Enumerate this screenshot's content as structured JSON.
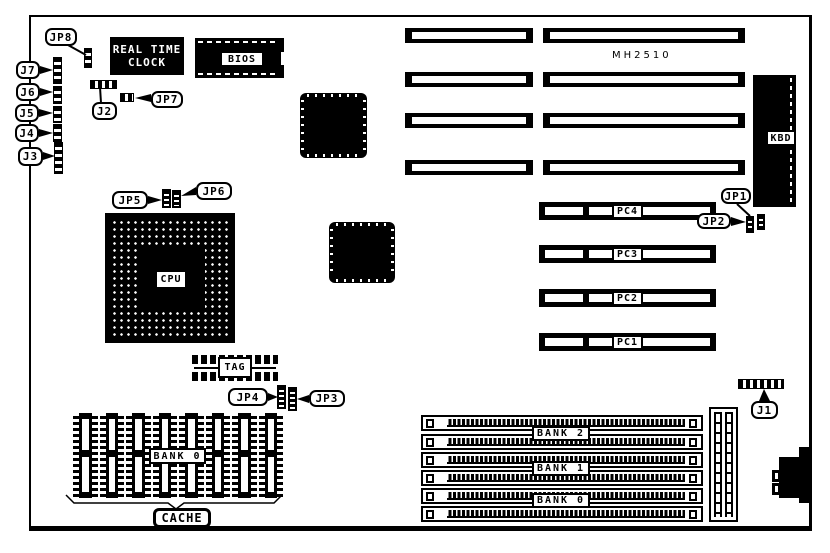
{
  "diagram": {
    "model_text": "MH2510",
    "colors": {
      "ink": "#000000",
      "paper": "#ffffff"
    }
  },
  "components": {
    "rtc_line1": "REAL TIME",
    "rtc_line2": "CLOCK",
    "bios_label": "BIOS",
    "cpu_label": "CPU",
    "tag_label": "TAG",
    "kbd_label": "KBD",
    "cache_bank_label": "BANK 0",
    "cache_label": "CACHE"
  },
  "pci_slots": [
    {
      "label": "PC4"
    },
    {
      "label": "PC3"
    },
    {
      "label": "PC2"
    },
    {
      "label": "PC1"
    }
  ],
  "simm_banks": [
    {
      "label": "BANK 2"
    },
    {
      "label": "BANK 1"
    },
    {
      "label": "BANK 0"
    }
  ],
  "connectors": [
    {
      "label": "J7"
    },
    {
      "label": "J6"
    },
    {
      "label": "J5"
    },
    {
      "label": "J4"
    },
    {
      "label": "J3"
    },
    {
      "label": "J2"
    },
    {
      "label": "J1"
    }
  ],
  "jumpers": [
    {
      "label": "JP8"
    },
    {
      "label": "JP7"
    },
    {
      "label": "JP6"
    },
    {
      "label": "JP5"
    },
    {
      "label": "JP4"
    },
    {
      "label": "JP3"
    },
    {
      "label": "JP2"
    },
    {
      "label": "JP1"
    }
  ]
}
